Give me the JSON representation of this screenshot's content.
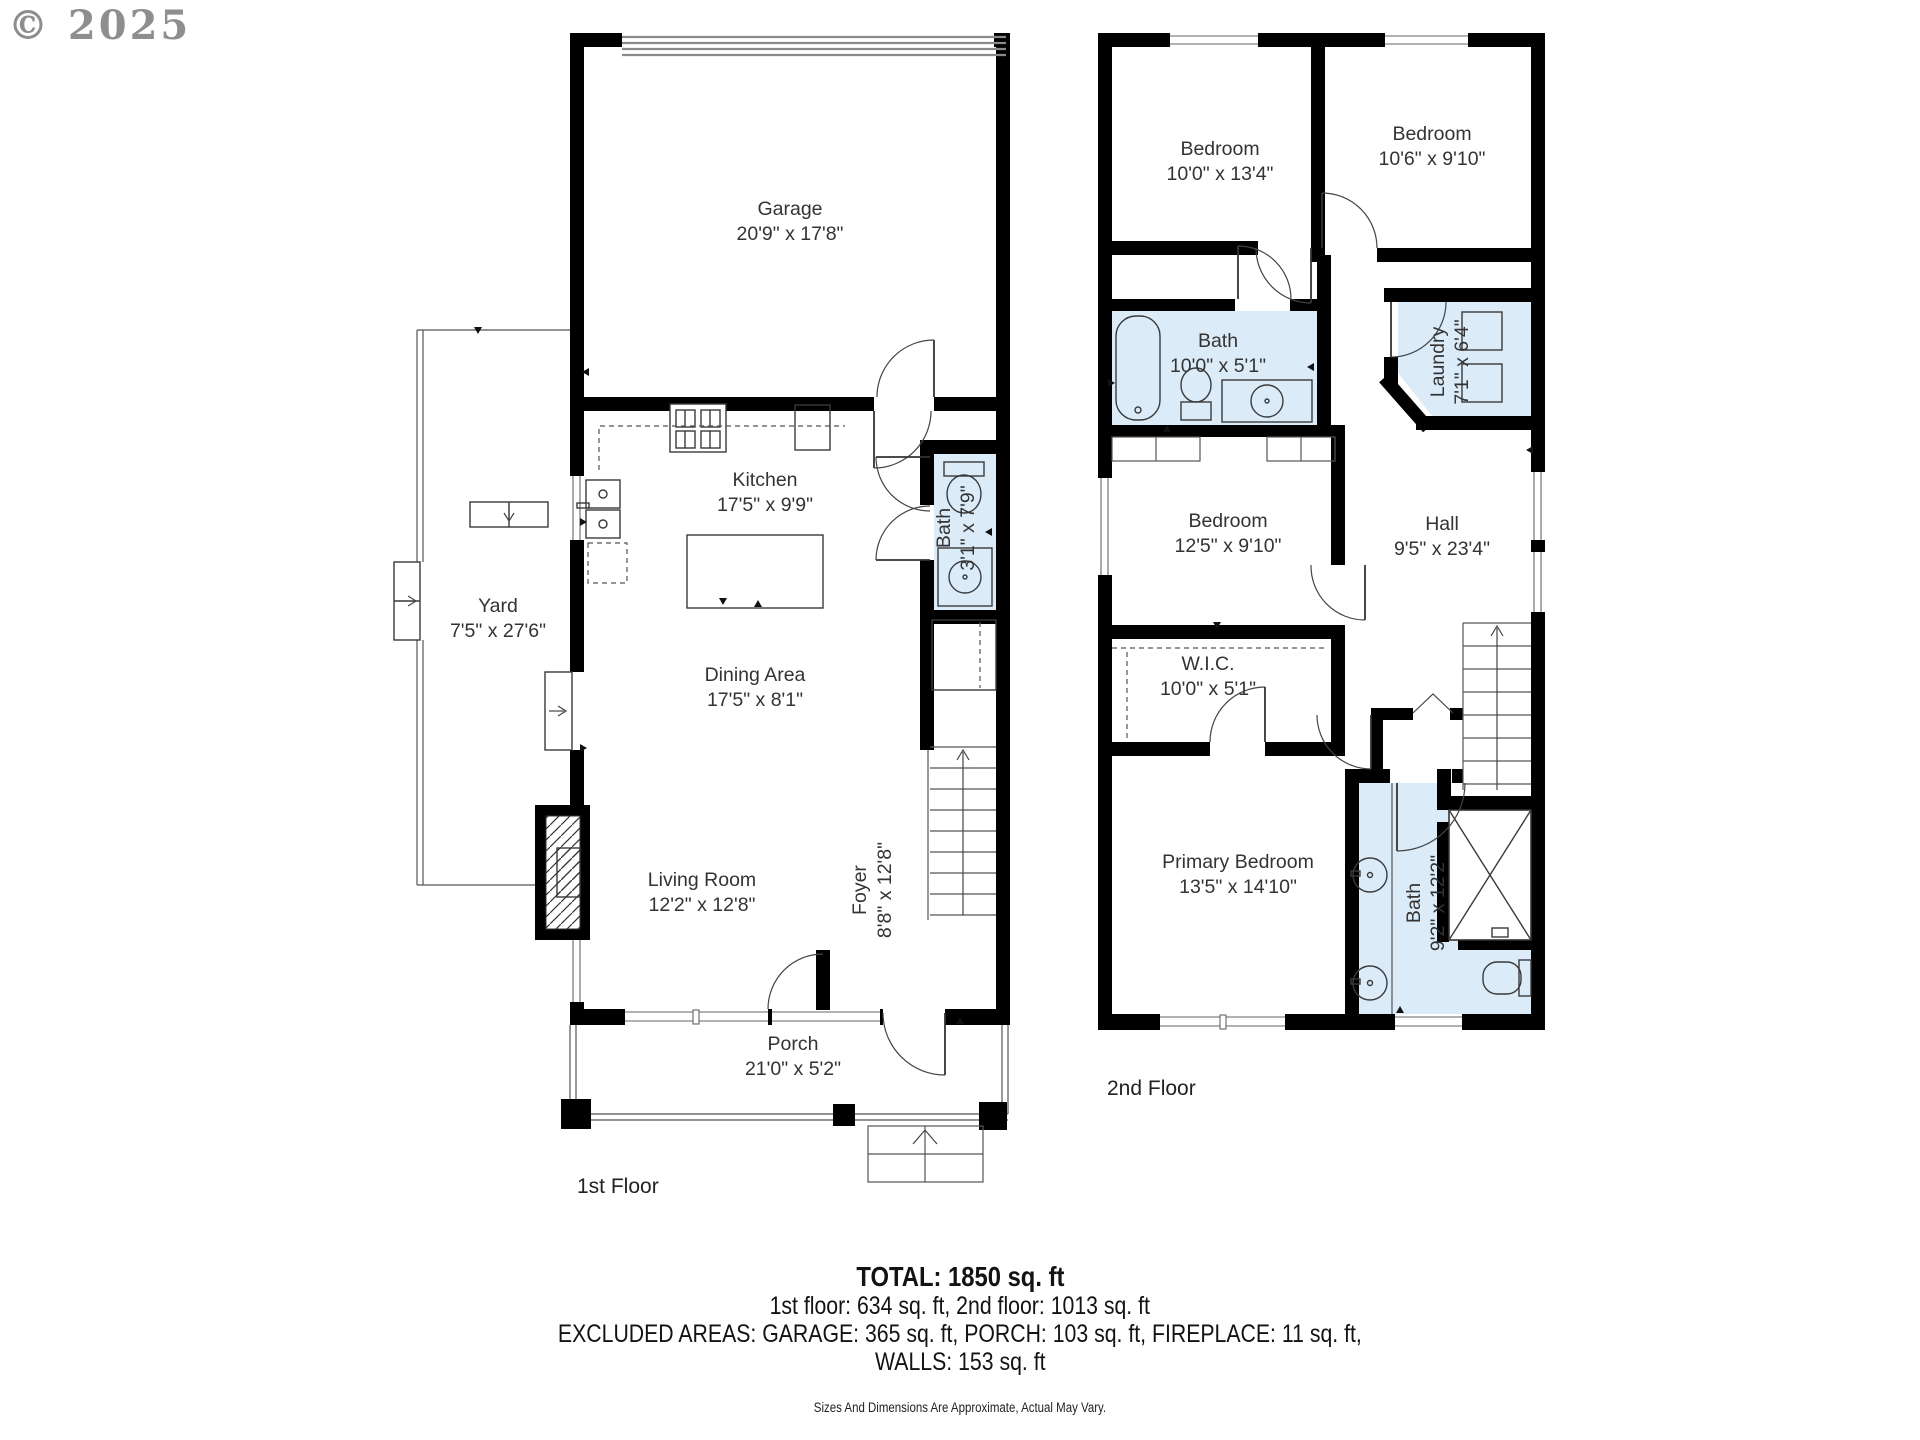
{
  "watermark": "© 2025",
  "colors": {
    "wall": "#000000",
    "bath_fill": "#dcebf8",
    "label": "#333333",
    "watermark": "#8e8e8e"
  },
  "floor1": {
    "label": "1st Floor",
    "rooms": {
      "garage": {
        "name": "Garage",
        "dims": "20'9\" x 17'8\""
      },
      "kitchen": {
        "name": "Kitchen",
        "dims": "17'5\" x 9'9\""
      },
      "yard": {
        "name": "Yard",
        "dims": "7'5\" x 27'6\""
      },
      "dining": {
        "name": "Dining Area",
        "dims": "17'5\" x 8'1\""
      },
      "living": {
        "name": "Living Room",
        "dims": "12'2\" x 12'8\""
      },
      "foyer": {
        "name": "Foyer",
        "dims": "8'8\" x 12'8\""
      },
      "bath": {
        "name": "Bath",
        "dims": "3'1\" x 7'9\""
      },
      "porch": {
        "name": "Porch",
        "dims": "21'0\" x 5'2\""
      }
    }
  },
  "floor2": {
    "label": "2nd Floor",
    "rooms": {
      "bedroom_tl": {
        "name": "Bedroom",
        "dims": "10'0\" x 13'4\""
      },
      "bedroom_tr": {
        "name": "Bedroom",
        "dims": "10'6\" x 9'10\""
      },
      "bath": {
        "name": "Bath",
        "dims": "10'0\" x 5'1\""
      },
      "laundry": {
        "name": "Laundry",
        "dims": "7'1\" x 6'4\""
      },
      "bedroom_mid": {
        "name": "Bedroom",
        "dims": "12'5\" x 9'10\""
      },
      "hall": {
        "name": "Hall",
        "dims": "9'5\" x 23'4\""
      },
      "wic": {
        "name": "W.I.C.",
        "dims": "10'0\" x 5'1\""
      },
      "primary": {
        "name": "Primary Bedroom",
        "dims": "13'5\" x 14'10\""
      },
      "bath_primary": {
        "name": "Bath",
        "dims": "9'2\" x 12'2\""
      }
    }
  },
  "footer": {
    "total": "TOTAL: 1850 sq. ft",
    "floors": "1st floor: 634 sq. ft, 2nd floor: 1013 sq. ft",
    "excluded": "EXCLUDED AREAS: GARAGE: 365 sq. ft, PORCH: 103 sq. ft, FIREPLACE: 11 sq. ft,",
    "walls": "WALLS: 153 sq. ft",
    "disclaimer": "Sizes And Dimensions Are Approximate, Actual May Vary."
  }
}
